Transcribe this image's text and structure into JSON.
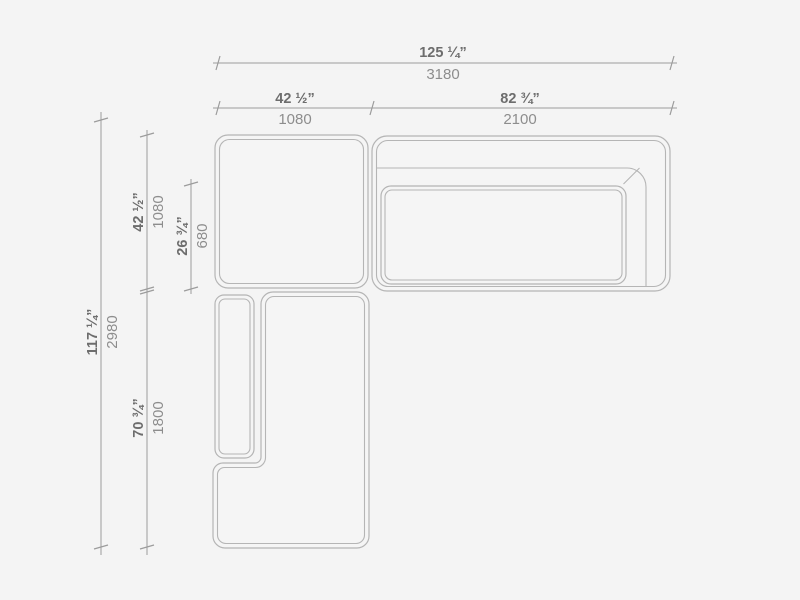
{
  "page": {
    "description": "Top-view dimension drawing of a modular corner sofa with chaise"
  },
  "colors": {
    "background": "#f4f4f4",
    "outline": "#b5b5b5",
    "module-fill": "#f5f5f5",
    "dim-line": "#9c9c9c",
    "inch-text": "#6d6d6d",
    "mm-text": "#8d8d8d"
  },
  "dimensions": {
    "width_total": {
      "inches": "125 ¼”",
      "mm": "3180"
    },
    "width_left": {
      "inches": "42 ½”",
      "mm": "1080"
    },
    "width_right": {
      "inches": "82 ¾”",
      "mm": "2100"
    },
    "depth_total": {
      "inches": "117 ¼”",
      "mm": "2980"
    },
    "depth_top_module": {
      "inches": "42 ½”",
      "mm": "1080"
    },
    "depth_seat": {
      "inches": "26 ¾”",
      "mm": "680"
    },
    "depth_chaise": {
      "inches": "70 ¾”",
      "mm": "1800"
    }
  }
}
